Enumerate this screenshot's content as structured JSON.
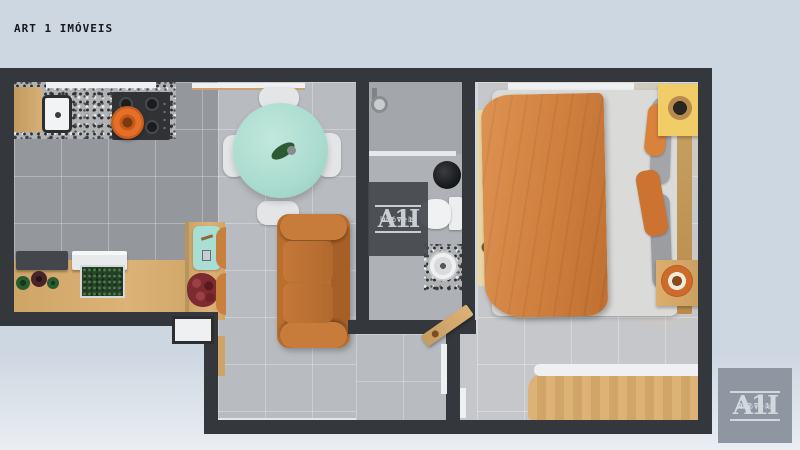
{
  "watermark_text": "ART 1 IMÓVEIS",
  "brand": {
    "line1": "ART 1",
    "glyph": "A1I",
    "line2": "Imóveis"
  },
  "palette": {
    "wall": "#34373c",
    "bgTop": "#cdd7e2",
    "bgBottom": "#eaeef3",
    "kitchenFloor": "#94979c",
    "livingFloor": "#b8bbc0",
    "bathFloor": "#aeb1b6",
    "showerFloor": "#a3a6ab",
    "bedFloor": "#c5c7ca",
    "wood": "#cfa567",
    "woodLight": "#dcb277",
    "mint": "#aadccf",
    "teal": "#a8ded4",
    "orangeSofa": "#b9702f",
    "orangeBlanket": "#cf7f3e",
    "orangePot": "#e56f28",
    "yellowNightstand": "#f1cd68",
    "rug": "#e9d6a4",
    "roses": "#7c2b30",
    "white": "#eef0f2",
    "logoBg": "#8e96a2",
    "logoText": "#d3d8de",
    "watermarkBg": "#44484d",
    "textDark": "#17191b"
  }
}
